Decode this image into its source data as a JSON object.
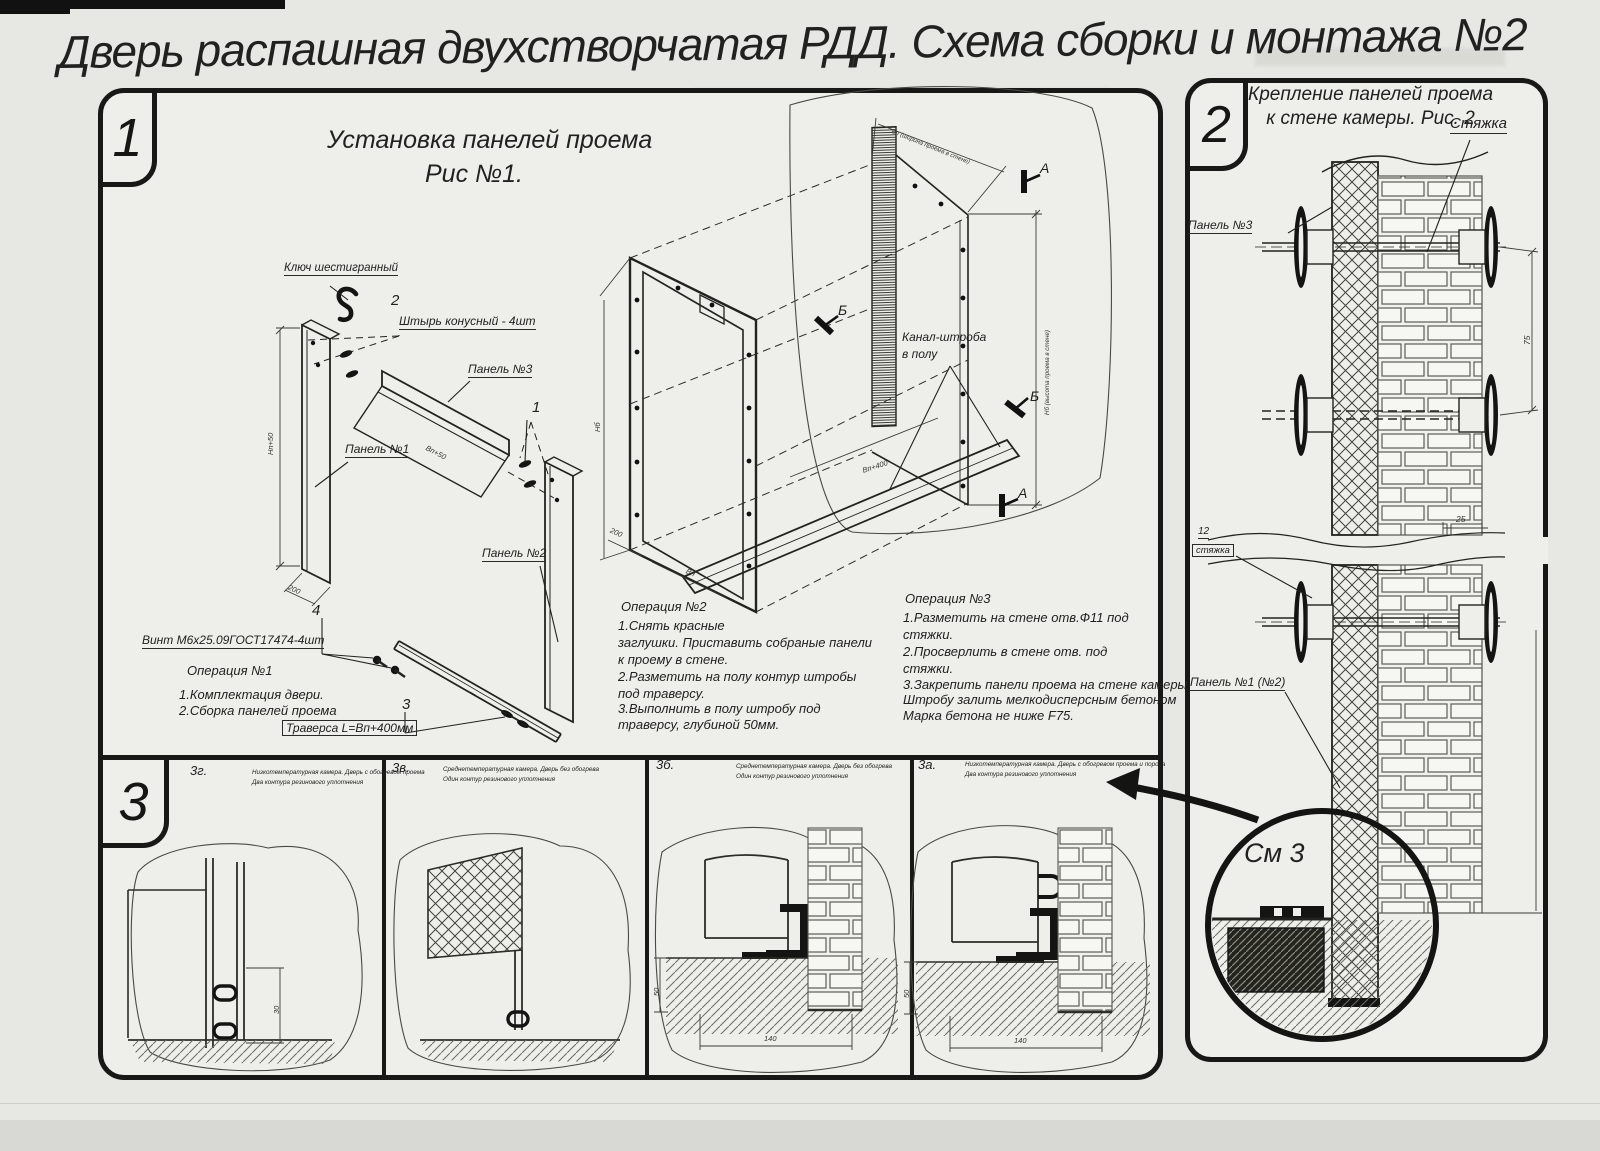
{
  "title": "Дверь распашная двухстворчатая РДД.  Схема сборки и монтажа №2",
  "s1": {
    "badge": "1",
    "head1": "Установка панелей проема",
    "head2": "Рис №1.",
    "labels": {
      "hexkey": "Ключ шестигранный",
      "num2": "2",
      "pin": "Штырь конусный - 4шт",
      "panel3": "Панель №3",
      "panel1": "Панель №1",
      "num1": "1",
      "panel2": "Панель №2",
      "num4": "4",
      "screw": "Винт М6х25.09ГОСТ17474-4шт",
      "num3": "3",
      "traverse": "Траверса  L=Вп+400мм",
      "canal1": "Канал-штроба",
      "canal2": "в полу",
      "secA": "А",
      "secB": "Б",
      "dim_np50": "Нп+50",
      "dim_200": "200",
      "dim_vp50": "Вп+50",
      "dim_vp400": "Вп+400",
      "dim_vp": "Вп",
      "dim_nb": "Нб",
      "dim_wtop": "Вп (ширина проема в стене)",
      "dim_hright": "Нб (высота проема в стене)"
    },
    "op1": {
      "t": "Операция №1",
      "l1": "1.Комплектация двери.",
      "l2": "2.Сборка панелей проема"
    },
    "op2": {
      "t": "Операция №2",
      "l1": "1.Снять красные",
      "l2": "заглушки. Приставить собраные панели",
      "l3": "к проему в стене.",
      "l4": "2.Разметить на полу контур штробы",
      "l5": "под траверсу.",
      "l6": "3.Выполнить в полу штробу под",
      "l7": "траверсу, глубиной 50мм."
    },
    "op3": {
      "t": "Операция №3",
      "l1": "1.Разметить на стене отв.Ф11 под",
      "l2": "стяжки.",
      "l3": "2.Просверлить в стене отв.  под",
      "l4": "стяжки.",
      "l5": "3.Закрепить панели проема на стене камеры.",
      "l6": "Штробу залить мелкодисперсным бетоном",
      "l7": "Марка бетона не ниже   F75."
    }
  },
  "s2": {
    "badge": "2",
    "head1": "Крепление панелей проема",
    "head2": "к стене камеры. Рис. 2",
    "labels": {
      "tie": "Стяжка",
      "panel3": "Панель №3",
      "tie_num": "12",
      "tie_word": "стяжка",
      "panel12": "Панель №1 (№2)",
      "see3": "См 3",
      "dim75": "75",
      "dim25": "25"
    }
  },
  "s3": {
    "badge": "3",
    "items": [
      {
        "label": "3г.",
        "d1": "Низкотемпературная камера. Дверь с обогревом проема",
        "d2": "Два контура резинового уплотнения",
        "dim_v": "30"
      },
      {
        "label": "3в.",
        "d1": "Среднетемпературная камера. Дверь без обогрева",
        "d2": "Один контур резинового уплотнения"
      },
      {
        "label": "3б.",
        "d1": "Среднетемпературная камера. Дверь без обогрева",
        "d2": "Один контур резинового уплотнения",
        "dim_v": "50",
        "dim_h": "140"
      },
      {
        "label": "3а.",
        "d1": "Низкотемпературная камера. Дверь с обогревом проема и порога",
        "d2": "Два контура резинового уплотнения",
        "dim_v": "50",
        "dim_h": "140"
      }
    ]
  }
}
